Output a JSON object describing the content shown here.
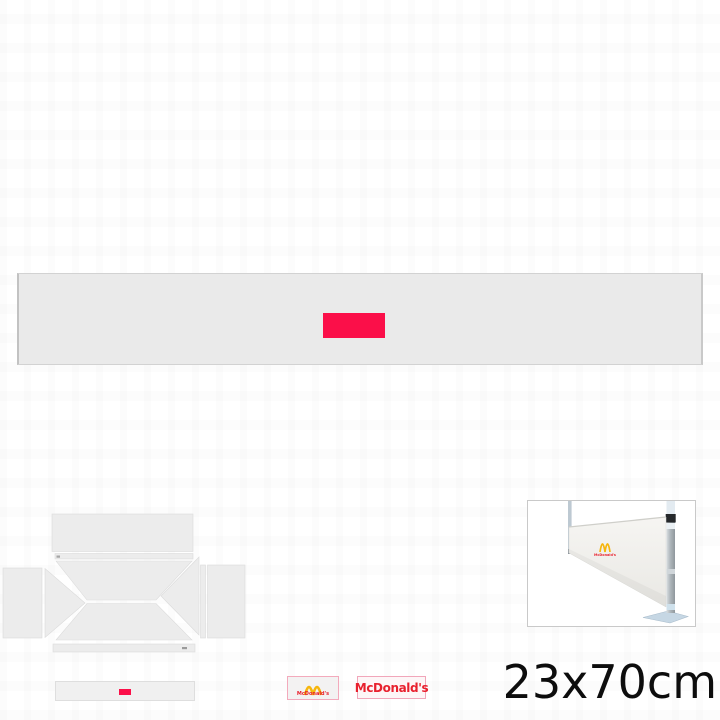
{
  "product": {
    "size_label": "23x70cm",
    "print_color": "#fb0f49"
  },
  "brand": {
    "wordmark": "McDonald's",
    "arches_color": "#f6b60c",
    "wordmark_color": "#e8212e"
  },
  "icons": {
    "golden_arches": "two-arch M shape",
    "zipper_mark": "small gray dash"
  },
  "palette": {
    "banner_fill": "#eaeaea",
    "banner_border": "#d2d2d2",
    "panel_fill": "#ececec",
    "panel_border": "#dbdbdb",
    "mini_banner_fill": "#f0f0f0",
    "logo_box_border": "#f3aabc",
    "logo_box_fill": "#f3f2f2",
    "wordmark_box_fill": "#fdf6f7",
    "photo_frame_border": "#c9c9c9",
    "photo_banner_fill": "#f2f1ee",
    "pole_metal": "#b1b8bd",
    "pole_top_sleeve": "#e3ebf1",
    "pole_accent_blue": "#cfe1ec",
    "clamp_black": "#25282b",
    "foot_plate": "#c6d7e4",
    "size_text_color": "#0d0d0d"
  }
}
